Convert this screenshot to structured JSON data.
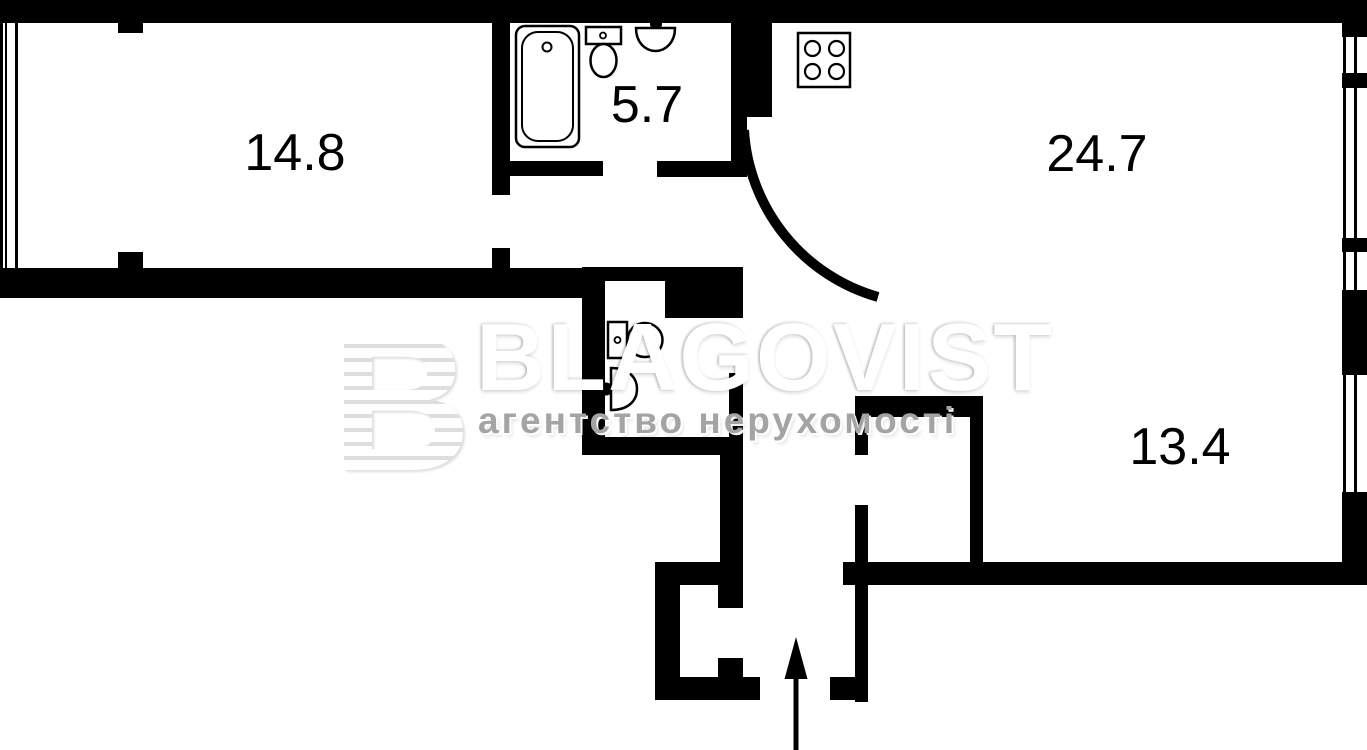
{
  "plan": {
    "background_color": "#ffffff",
    "wall_color": "#000000",
    "rooms": [
      {
        "id": "room-left",
        "area": "14.8"
      },
      {
        "id": "bathroom",
        "area": "5.7"
      },
      {
        "id": "kitchen-living",
        "area": "24.7"
      },
      {
        "id": "room-right",
        "area": "13.4"
      }
    ],
    "icons": [
      "bathtub-icon",
      "toilet-icon",
      "sink-icon",
      "stove-icon",
      "toilet-icon",
      "sink-icon",
      "door-swing-icon",
      "entrance-arrow-icon",
      "window-icon"
    ]
  },
  "watermark": {
    "logo_letter": "B",
    "brand": "BLAGOVIST",
    "tagline": "агентство нерухомості",
    "brand_color": "#ffffff",
    "tagline_color": "#a4a4a4"
  }
}
